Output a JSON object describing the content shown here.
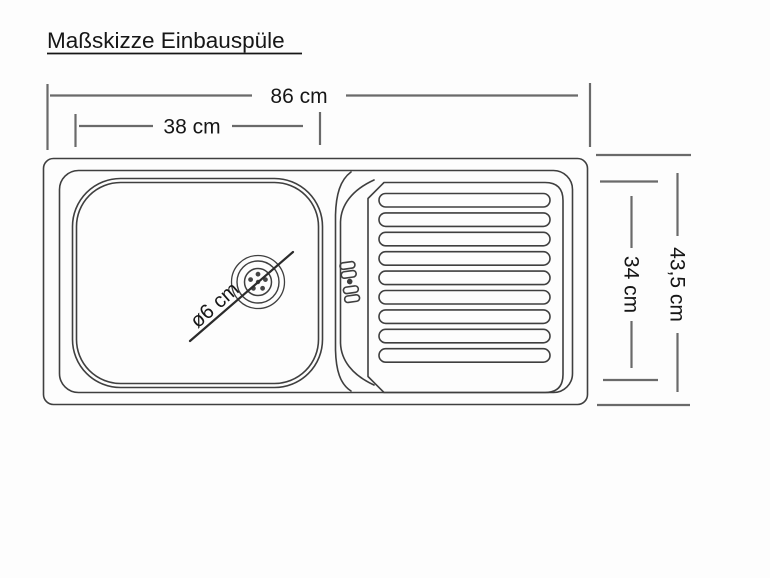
{
  "title": "Maßskizze Einbauspüle",
  "dimensions": {
    "total_width": "86 cm",
    "basin_width": "38 cm",
    "total_depth": "43,5 cm",
    "inner_depth": "34 cm",
    "drain_diameter": "ø6 cm"
  },
  "colors": {
    "background": "#fdfdfd",
    "outline": "#3f3f3f",
    "dimension_line": "#6a6a6a",
    "text": "#161616"
  }
}
